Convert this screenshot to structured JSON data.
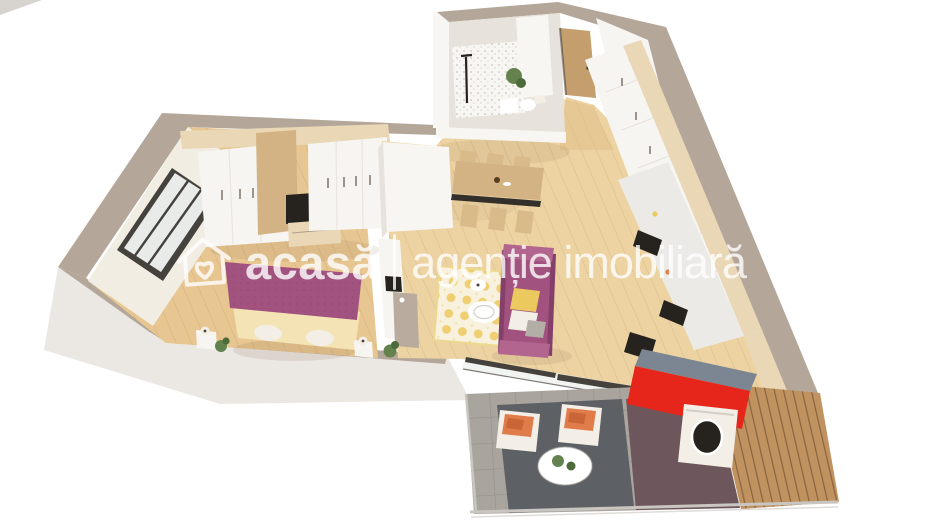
{
  "watermark": {
    "logo_icon": "house-heart-icon",
    "brand": "acasă",
    "separator": "|",
    "tagline": "agenție imobiliară",
    "text_color": "#ffffff",
    "opacity": "0.8"
  },
  "scene": {
    "description": "3D isometric render of a two-room apartment floor plan, viewed from above at an angle, white background",
    "rooms": [
      {
        "name": "bedroom",
        "contents": [
          "wardrobes",
          "tv-panel",
          "double-bed-purple",
          "window",
          "nightstands",
          "plant"
        ]
      },
      {
        "name": "living-dining",
        "contents": [
          "dining-table",
          "six-chairs",
          "purple-sofa",
          "yellow-pattern-rug",
          "coffee-table",
          "tv-console",
          "plant",
          "sliding-glass-doors"
        ]
      },
      {
        "name": "kitchen",
        "contents": [
          "white-cabinet-run",
          "marble-counter",
          "cooktop",
          "sink",
          "oven"
        ]
      },
      {
        "name": "bathroom",
        "contents": [
          "shower",
          "toilet",
          "plant",
          "speckled-accent-wall"
        ]
      },
      {
        "name": "hallway",
        "contents": [
          "entry-door",
          "closet-run"
        ]
      },
      {
        "name": "balcony",
        "contents": [
          "washing-machine",
          "two-lounge-chairs",
          "orange-cushions",
          "round-table",
          "gray-rug",
          "wood-deck",
          "red-accent-wall"
        ]
      }
    ]
  },
  "palette": {
    "wallTop": "#b4a79a",
    "wallFace": "#ebe8e4",
    "cornerGray": "#d7d3cf",
    "innerWall": "#f2ede3",
    "innerWallBright": "#f8f6f2",
    "innerWallShade": "#e7e2db",
    "floorBedroom": "#e7c691",
    "floorLiving": "#edd3a2",
    "floorHall": "#e0bf8a",
    "plankLine": "#916838",
    "lightWood": "#e9d7b6",
    "woodTrim": "#d3b384",
    "woodDoor": "#c49e6c",
    "cabinetWhite": "#f7f5f1",
    "consoleTaupe": "#b9ac9f",
    "handleGray": "#857c72",
    "seamGray": "#d8d2c9",
    "darkFrame": "#45413c",
    "glass": "#e8ebe8",
    "black": "#26231f",
    "marble": "#eceae6",
    "purple": "#a2527e",
    "purpleDark": "#84406a",
    "purpleLight": "#b2658f",
    "cream": "#f4e4b5",
    "pillowWhite": "#f3efe7",
    "pillowGray": "#b3aea6",
    "yellow": "#ecc95e",
    "rugBase": "#f7f1de",
    "rugBorder": "#ecd98f",
    "chairWood": "#d9ba89",
    "benchDark": "#332f2b",
    "green": "#64824d",
    "greenDark": "#4c6a3a",
    "red": "#e6261b",
    "slate": "#7b8692",
    "balconyTile": "#a9a49e",
    "rugGray": "#5d6065",
    "maroon": "#6e575c",
    "deckWood": "#bf9260",
    "deckLine": "#5a3c1e",
    "orange": "#e07b4a",
    "orangeDark": "#c96536",
    "white": "#ffffff",
    "shadow": "#8a6b4c",
    "railGray": "#c9c5c0"
  }
}
